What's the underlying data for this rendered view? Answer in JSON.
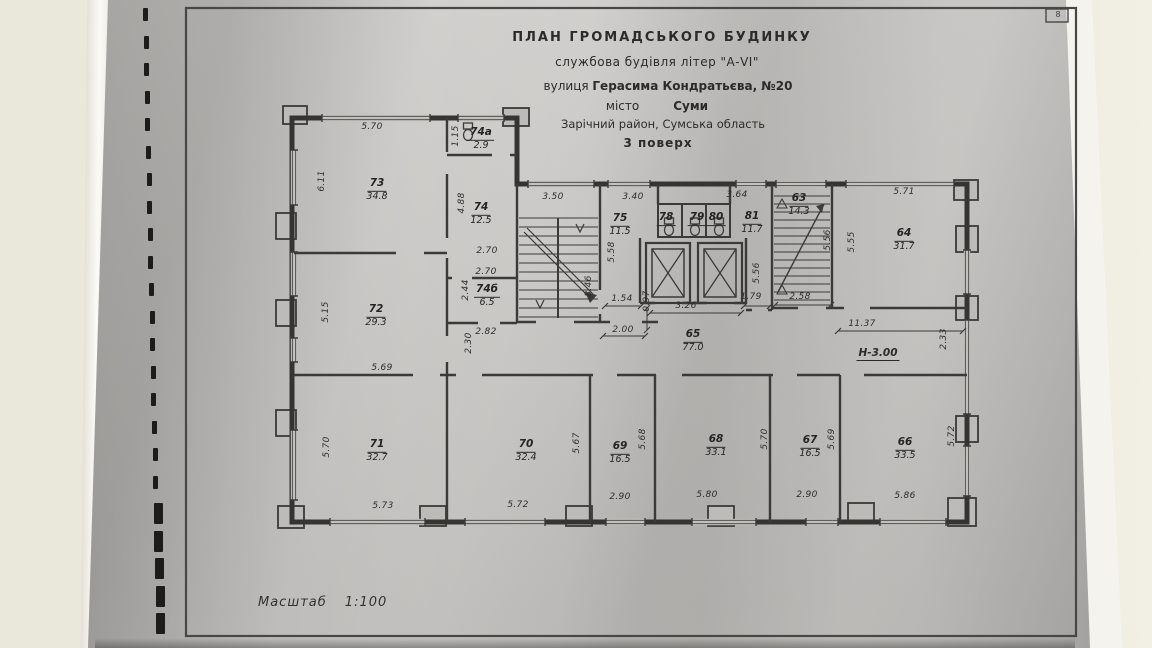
{
  "document": {
    "corner_mark": "8",
    "title_block": {
      "line1": "ПЛАН  ГРОМАДСЬКОГО  БУДИНКУ",
      "line2": "службова будівля літер \"А-VI\"",
      "line3_label": "вулиця",
      "line3_value": "Герасима Кондратьєва, №20",
      "line4_label": "місто",
      "line4_value": "Суми",
      "line5": "Зарічний район, Сумська область",
      "line6": "3 поверх"
    },
    "scale_label": "Масштаб",
    "scale_value": "1:100",
    "height_note": "Н-3.00"
  },
  "plan": {
    "rooms": [
      {
        "number": "73",
        "area": "34.8",
        "x": 377,
        "y": 187
      },
      {
        "number": "74а",
        "area": "2.9",
        "x": 481,
        "y": 136
      },
      {
        "number": "74",
        "area": "12.5",
        "x": 481,
        "y": 211
      },
      {
        "number": "72",
        "area": "29.3",
        "x": 376,
        "y": 313
      },
      {
        "number": "74б",
        "area": "6.5",
        "x": 487,
        "y": 293
      },
      {
        "number": "75",
        "area": "11.5",
        "x": 620,
        "y": 222
      },
      {
        "number": "78",
        "area": "",
        "x": 666,
        "y": 216
      },
      {
        "number": "79",
        "area": "",
        "x": 697,
        "y": 216
      },
      {
        "number": "80",
        "area": "",
        "x": 716,
        "y": 216
      },
      {
        "number": "81",
        "area": "11.7",
        "x": 752,
        "y": 220
      },
      {
        "number": "63",
        "area": "14.3",
        "x": 799,
        "y": 202
      },
      {
        "number": "64",
        "area": "31.7",
        "x": 904,
        "y": 237
      },
      {
        "number": "65",
        "area": "77.0",
        "x": 693,
        "y": 338
      },
      {
        "number": "71",
        "area": "32.7",
        "x": 377,
        "y": 448
      },
      {
        "number": "70",
        "area": "32.4",
        "x": 526,
        "y": 448
      },
      {
        "number": "69",
        "area": "16.5",
        "x": 620,
        "y": 450
      },
      {
        "number": "68",
        "area": "33.1",
        "x": 716,
        "y": 443
      },
      {
        "number": "67",
        "area": "16.5",
        "x": 810,
        "y": 444
      },
      {
        "number": "66",
        "area": "33.5",
        "x": 905,
        "y": 446
      }
    ],
    "dims_horizontal": [
      {
        "text": "5.70",
        "x": 372,
        "y": 127
      },
      {
        "text": "3.50",
        "x": 553,
        "y": 197
      },
      {
        "text": "3.40",
        "x": 633,
        "y": 197
      },
      {
        "text": "3.64",
        "x": 737,
        "y": 195
      },
      {
        "text": "5.71",
        "x": 904,
        "y": 192
      },
      {
        "text": "2.70",
        "x": 487,
        "y": 251
      },
      {
        "text": "2.70",
        "x": 486,
        "y": 272
      },
      {
        "text": "2.82",
        "x": 486,
        "y": 332
      },
      {
        "text": "1.54",
        "x": 622,
        "y": 299
      },
      {
        "text": "2.00",
        "x": 623,
        "y": 330
      },
      {
        "text": "3.26",
        "x": 686,
        "y": 306
      },
      {
        "text": "1.79",
        "x": 751,
        "y": 297
      },
      {
        "text": "2.58",
        "x": 800,
        "y": 297
      },
      {
        "text": "11.37",
        "x": 862,
        "y": 324
      },
      {
        "text": "5.69",
        "x": 382,
        "y": 368
      },
      {
        "text": "5.73",
        "x": 383,
        "y": 506
      },
      {
        "text": "5.72",
        "x": 518,
        "y": 505
      },
      {
        "text": "2.90",
        "x": 620,
        "y": 497
      },
      {
        "text": "5.80",
        "x": 707,
        "y": 495
      },
      {
        "text": "2.90",
        "x": 807,
        "y": 495
      },
      {
        "text": "5.86",
        "x": 905,
        "y": 496
      }
    ],
    "dims_vertical": [
      {
        "text": "6.11",
        "x": 322,
        "y": 181
      },
      {
        "text": "1.15",
        "x": 456,
        "y": 136
      },
      {
        "text": "4.88",
        "x": 462,
        "y": 203
      },
      {
        "text": "5.15",
        "x": 326,
        "y": 312
      },
      {
        "text": "2.44",
        "x": 466,
        "y": 290
      },
      {
        "text": "2.30",
        "x": 469,
        "y": 343
      },
      {
        "text": "8.46",
        "x": 589,
        "y": 286
      },
      {
        "text": "5.58",
        "x": 612,
        "y": 252
      },
      {
        "text": "0.97",
        "x": 647,
        "y": 301
      },
      {
        "text": "5.56",
        "x": 757,
        "y": 273
      },
      {
        "text": "5.56",
        "x": 828,
        "y": 240
      },
      {
        "text": "5.55",
        "x": 852,
        "y": 242
      },
      {
        "text": "2.33",
        "x": 944,
        "y": 339
      },
      {
        "text": "5.70",
        "x": 327,
        "y": 447
      },
      {
        "text": "5.67",
        "x": 577,
        "y": 443
      },
      {
        "text": "5.68",
        "x": 643,
        "y": 439
      },
      {
        "text": "5.70",
        "x": 765,
        "y": 439
      },
      {
        "text": "5.69",
        "x": 832,
        "y": 439
      },
      {
        "text": "5.72",
        "x": 952,
        "y": 436
      }
    ]
  }
}
